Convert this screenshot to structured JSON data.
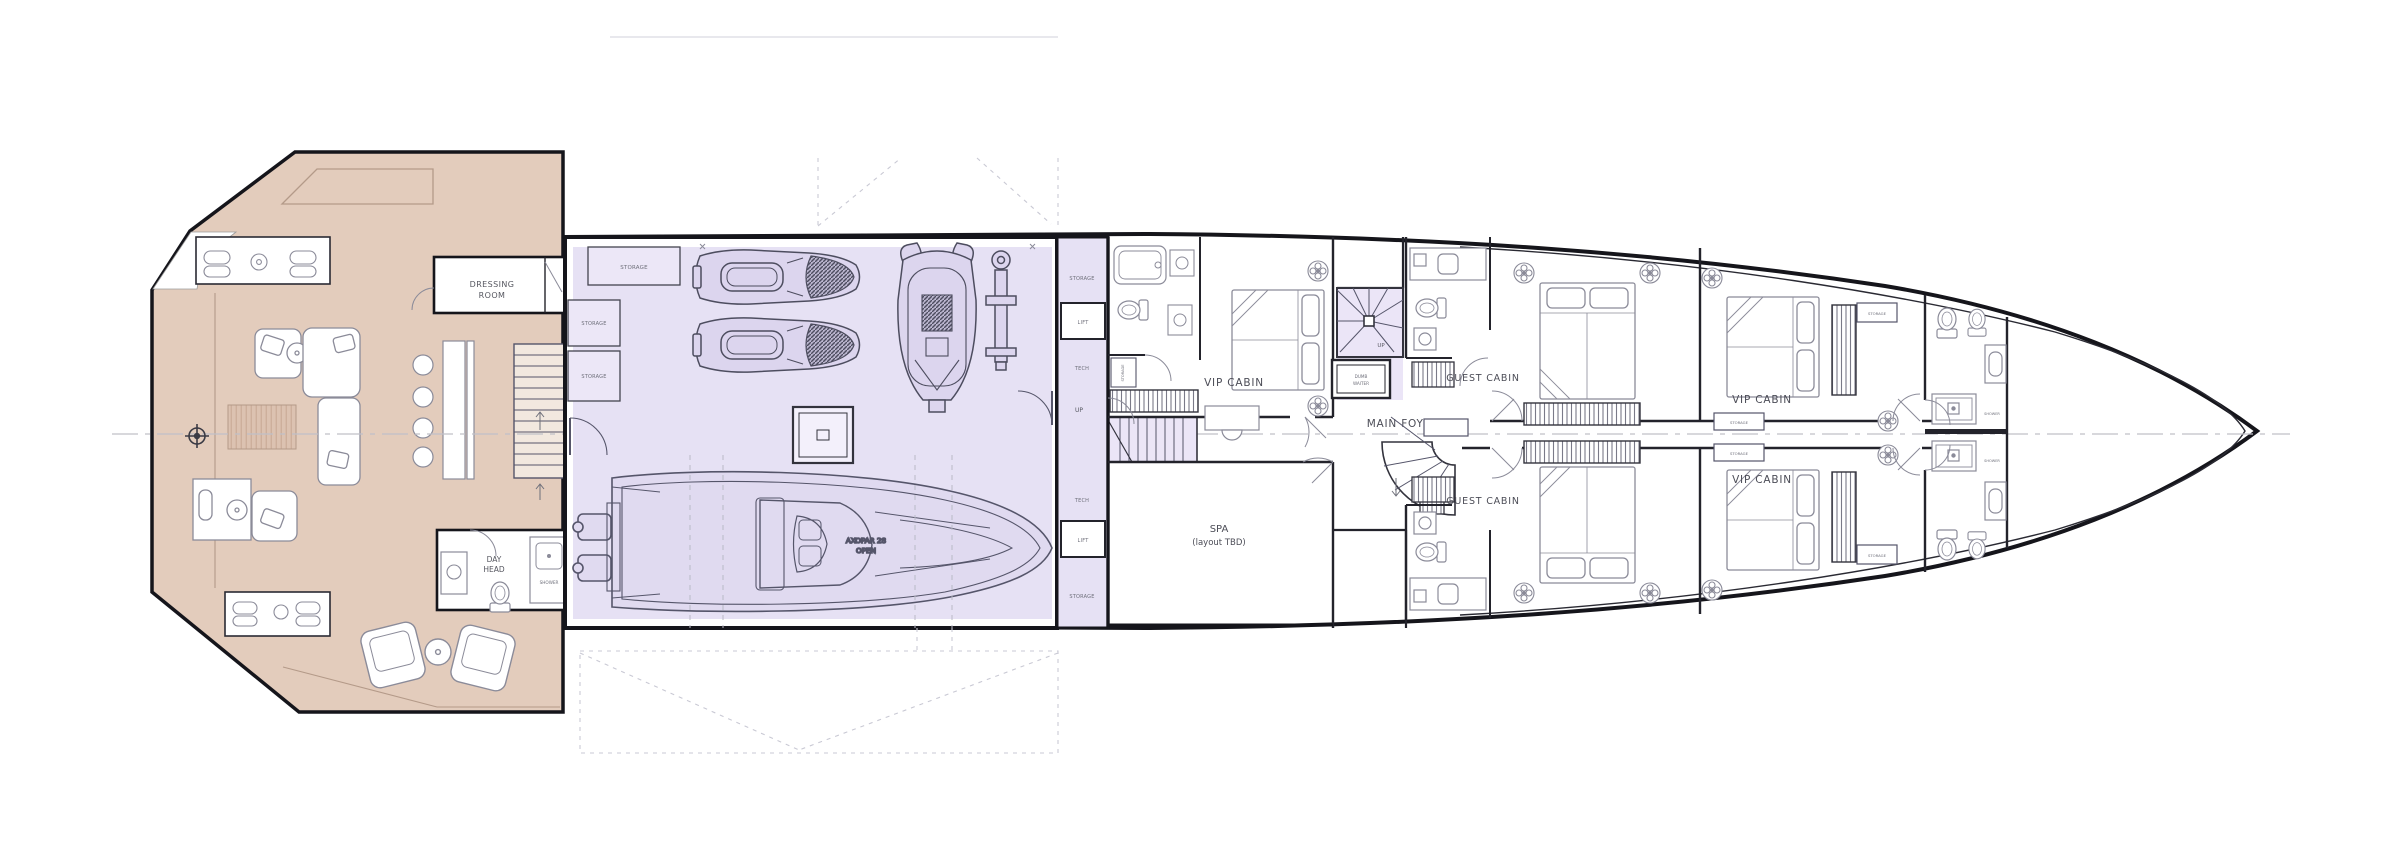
{
  "plan": {
    "type": "yacht-deck-floor-plan",
    "labels": {
      "dressing_l1": "DRESSING",
      "dressing_l2": "ROOM",
      "day_head_l1": "DAY",
      "day_head_l2": "HEAD",
      "shower": "SHOWER",
      "vip_cabin": "VIP CABIN",
      "guest_cabin": "GUEST CABIN",
      "main_foyer": "MAIN FOYER",
      "spa_l1": "SPA",
      "spa_l2": "(layout TBD)",
      "dumb_l1": "DUMB",
      "dumb_l2": "WAITER",
      "tender_l1": "AXOPAR 28",
      "tender_l2": "OPEN",
      "storage": "STORAGE",
      "tech": "TECH",
      "lift": "LIFT",
      "up": "UP"
    },
    "colors": {
      "deck_tan": "#e3ccbc",
      "garage_lavender": "#e6e1f4",
      "stair_lavender": "#ebe5f7",
      "hull_line": "#15151b",
      "wall_line": "#23232b",
      "furniture_line": "#8b8b99",
      "equipment_line": "#55556a",
      "centerline": "#c0c0c8",
      "dashed_guide": "#c9c9d4",
      "rug_fill": "#dcc2b1",
      "label_dark": "#4c4d57",
      "label_tiny": "#6e6f7a"
    }
  }
}
